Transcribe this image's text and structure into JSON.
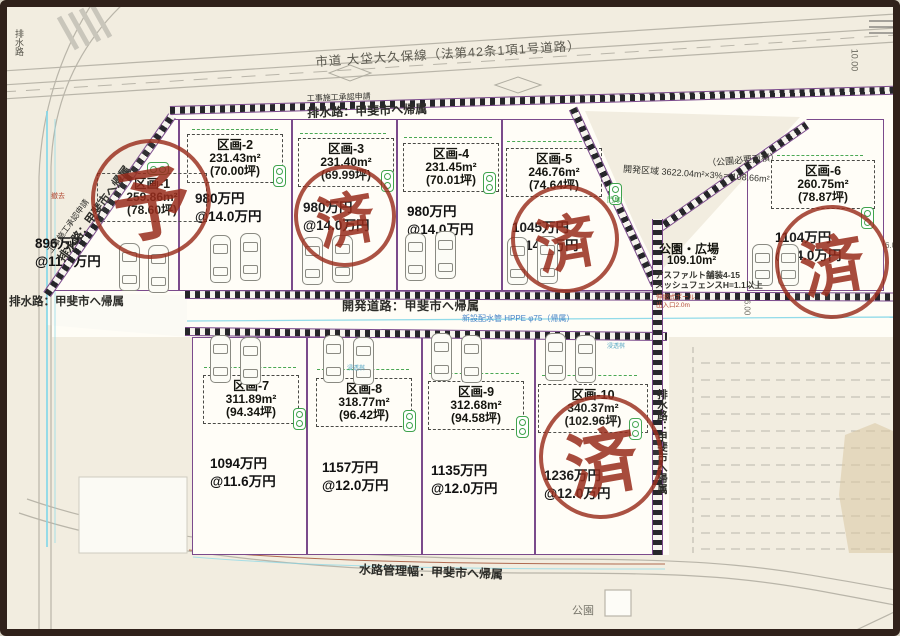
{
  "roads": {
    "city_road": "市道 大垈大久保線（法第42条1項1号道路）",
    "approval_note_top": "工事施工承認申請",
    "drain_top": "排水路：甲斐市へ帰属",
    "approval_note_diag": "工事施工承認申請",
    "drain_diag": "排水路：甲斐市へ帰属",
    "drain_left": "排水路：甲斐市へ帰属",
    "drain_topleft_vertical": "排水路",
    "dev_road": "開発道路：甲斐市へ帰属",
    "water_pipe": "新設配水管 HPPE φ75（帰属）",
    "drain_right_vertical": "排水路：甲斐市へ帰属",
    "waterway_bottom": "水路管理幅：甲斐市へ帰属",
    "park_bottom": "公園"
  },
  "park": {
    "required_note": "（公園必要面積）",
    "calc": "開発区域 3622.04m²×3%＝108.66m²",
    "name": "公園・広場",
    "area": "109.10m²",
    "paving": "アスファルト舗装4-15",
    "fence": "メッシュフェンスH=1.1以上",
    "pole": "伸縮式ポール",
    "entrance": "出入口2.0m",
    "gate": "門扉"
  },
  "dims": {
    "d10": "10.00",
    "d6a": "6.00",
    "d6b": "6.0"
  },
  "misc": {
    "removal": "撤去",
    "infiltration": "浸透桝"
  },
  "plots": [
    {
      "id": "区画-1",
      "area": "259.86m²",
      "tsubo": "(78.60坪)",
      "price": "896万円",
      "unit": "@11.4万円",
      "stamp": "予"
    },
    {
      "id": "区画-2",
      "area": "231.43m²",
      "tsubo": "(70.00坪)",
      "price": "980万円",
      "unit": "@14.0万円"
    },
    {
      "id": "区画-3",
      "area": "231.40m²",
      "tsubo": "(69.99坪)",
      "price": "980万円",
      "unit": "@14.0万円",
      "stamp": "済"
    },
    {
      "id": "区画-4",
      "area": "231.45m²",
      "tsubo": "(70.01坪)",
      "price": "980万円",
      "unit": "@14.0万円"
    },
    {
      "id": "区画-5",
      "area": "246.76m²",
      "tsubo": "(74.64坪)",
      "price": "1045万円",
      "unit": "@14.0万円",
      "stamp": "済"
    },
    {
      "id": "区画-6",
      "area": "260.75m²",
      "tsubo": "(78.87坪)",
      "price": "1104万円",
      "unit": "@14.0万円",
      "stamp": "済"
    },
    {
      "id": "区画-7",
      "area": "311.89m²",
      "tsubo": "(94.34坪)",
      "price": "1094万円",
      "unit": "@11.6万円"
    },
    {
      "id": "区画-8",
      "area": "318.77m²",
      "tsubo": "(96.42坪)",
      "price": "1157万円",
      "unit": "@12.0万円"
    },
    {
      "id": "区画-9",
      "area": "312.68m²",
      "tsubo": "(94.58坪)",
      "price": "1135万円",
      "unit": "@12.0万円"
    },
    {
      "id": "区画-10",
      "area": "340.37m²",
      "tsubo": "(102.96坪)",
      "price": "1236万円",
      "unit": "@12.0万円",
      "stamp": "済"
    }
  ]
}
